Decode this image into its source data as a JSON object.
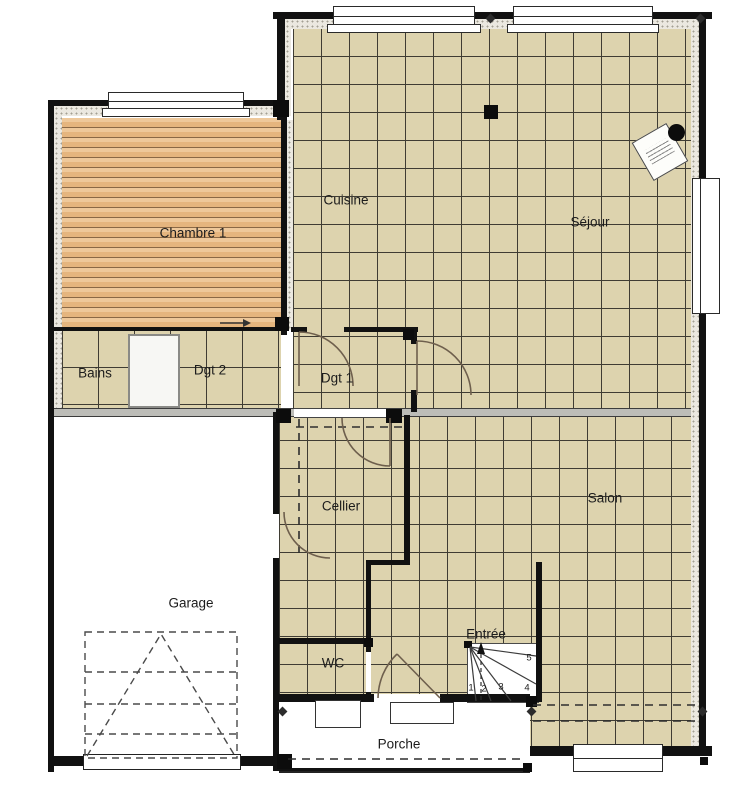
{
  "plan": {
    "rooms": {
      "cuisine": "Cuisine",
      "sejour": "Séjour",
      "chambre1": "Chambre 1",
      "bains": "Bains",
      "dgt2": "Dgt 2",
      "dgt1": "Dgt 1",
      "cellier": "Cellier",
      "salon": "Salon",
      "garage": "Garage",
      "wc": "WC",
      "entree": "Entrée",
      "porche": "Porche"
    },
    "stair_steps": [
      "1",
      "2",
      "3",
      "4",
      "5"
    ],
    "colors": {
      "tile_floor": "#ddd3ae",
      "tile_grout": "#3f3c33",
      "wood_floor": "#e9bf8e",
      "wall": "#111111"
    }
  }
}
